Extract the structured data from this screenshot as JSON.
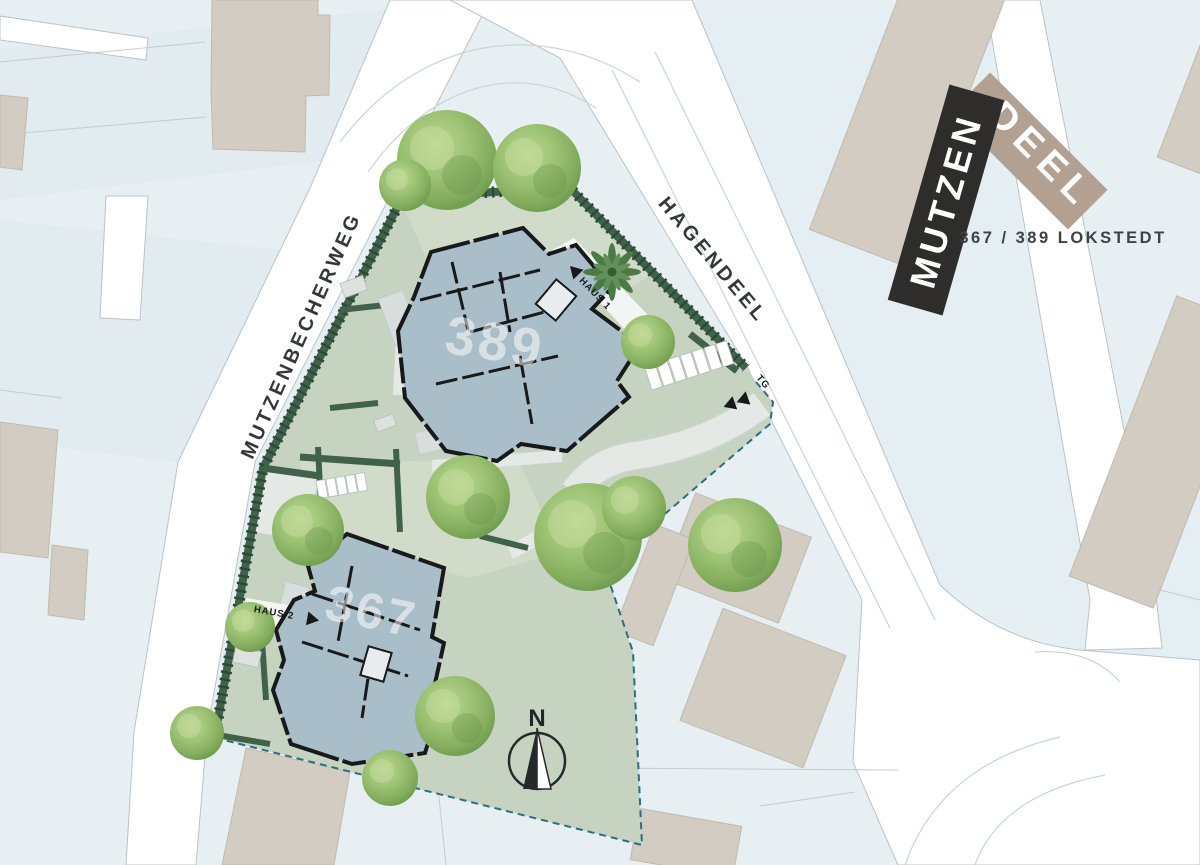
{
  "labels": {
    "street_left": "MUTZENBECHERWEG",
    "street_right": "HAGENDEEL"
  },
  "buildings": {
    "north": {
      "number": "389",
      "haus_label": "HAUS 1"
    },
    "south": {
      "number": "367",
      "haus_label": "HAUS 2"
    }
  },
  "garage": {
    "label": "TG"
  },
  "compass": {
    "north_letter": "N"
  },
  "logo": {
    "primary": "MUTZEN",
    "secondary": "DEEL",
    "subtitle": "367 / 389 LOKSTEDT"
  },
  "colors": {
    "bg": "#e7eff3",
    "parcel": "#e2ebf0",
    "parcel_alt": "#e5eef2",
    "road": "#ffffff",
    "road_edge": "#b9c3c8",
    "lane": "#ccd4d8",
    "parcel_line": "#c3ccd1",
    "neighbor": "#d3ccc2",
    "neighbor_edge": "#c1bab0",
    "lawn": "#c7d3c1",
    "garden": "#d1dbc9",
    "paving": "#e4e9e6",
    "terrace": "#d8dedd",
    "hedge": "#40624a",
    "hedge_tick": "#2b4a39",
    "boundary": "#2d6d82",
    "building": "#a9bec9",
    "wall": "#17191b",
    "white_path": "#f4f6f5",
    "tree_light": "#c5dd9c",
    "tree_mid": "#93ba6e",
    "tree_dark": "#65904a",
    "palm": "#4c7a47",
    "label": "#33383b",
    "logo_black": "#2e2d2c",
    "logo_tan": "#b2a092",
    "logo_text": "#ffffff",
    "subtitle": "#3e4246",
    "number": "#ffffff"
  }
}
